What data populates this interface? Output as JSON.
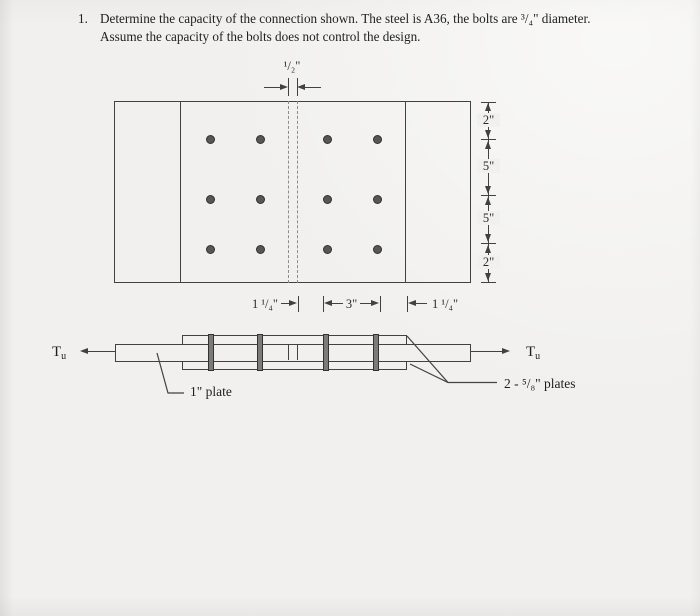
{
  "problem": {
    "number": "1.",
    "line1": "Determine the capacity of the connection shown.  The steel is A36, the bolts are ³/₄\" diameter.",
    "line2": "Assume the capacity of the bolts does not control the design."
  },
  "plan_view": {
    "dim_top": "¹/₂\"",
    "dims_right": [
      "2\"",
      "5\"",
      "5\"",
      "2\""
    ],
    "dims_bottom": [
      "1 ¹/₄\"",
      "3\"",
      "1 ¹/₄\""
    ],
    "bolt_grid": {
      "rows": 3,
      "cols": 4,
      "columns_x": [
        210,
        260,
        327,
        377
      ],
      "rows_y": [
        139,
        199,
        249
      ]
    }
  },
  "elevation_view": {
    "force_left": {
      "symbol": "T",
      "subscript": "u"
    },
    "force_right": {
      "symbol": "T",
      "subscript": "u"
    },
    "main_plate_label": "1\" plate",
    "splice_plates_label": "2 - ⁵/₈\" plates",
    "bolts_x": [
      211,
      260,
      326,
      376
    ]
  },
  "colors": {
    "ink": "#414141",
    "paper": "#f1f0ee",
    "bolt_plan_fill": "#565654",
    "bolt_elev_fill": "#7b7b78"
  }
}
